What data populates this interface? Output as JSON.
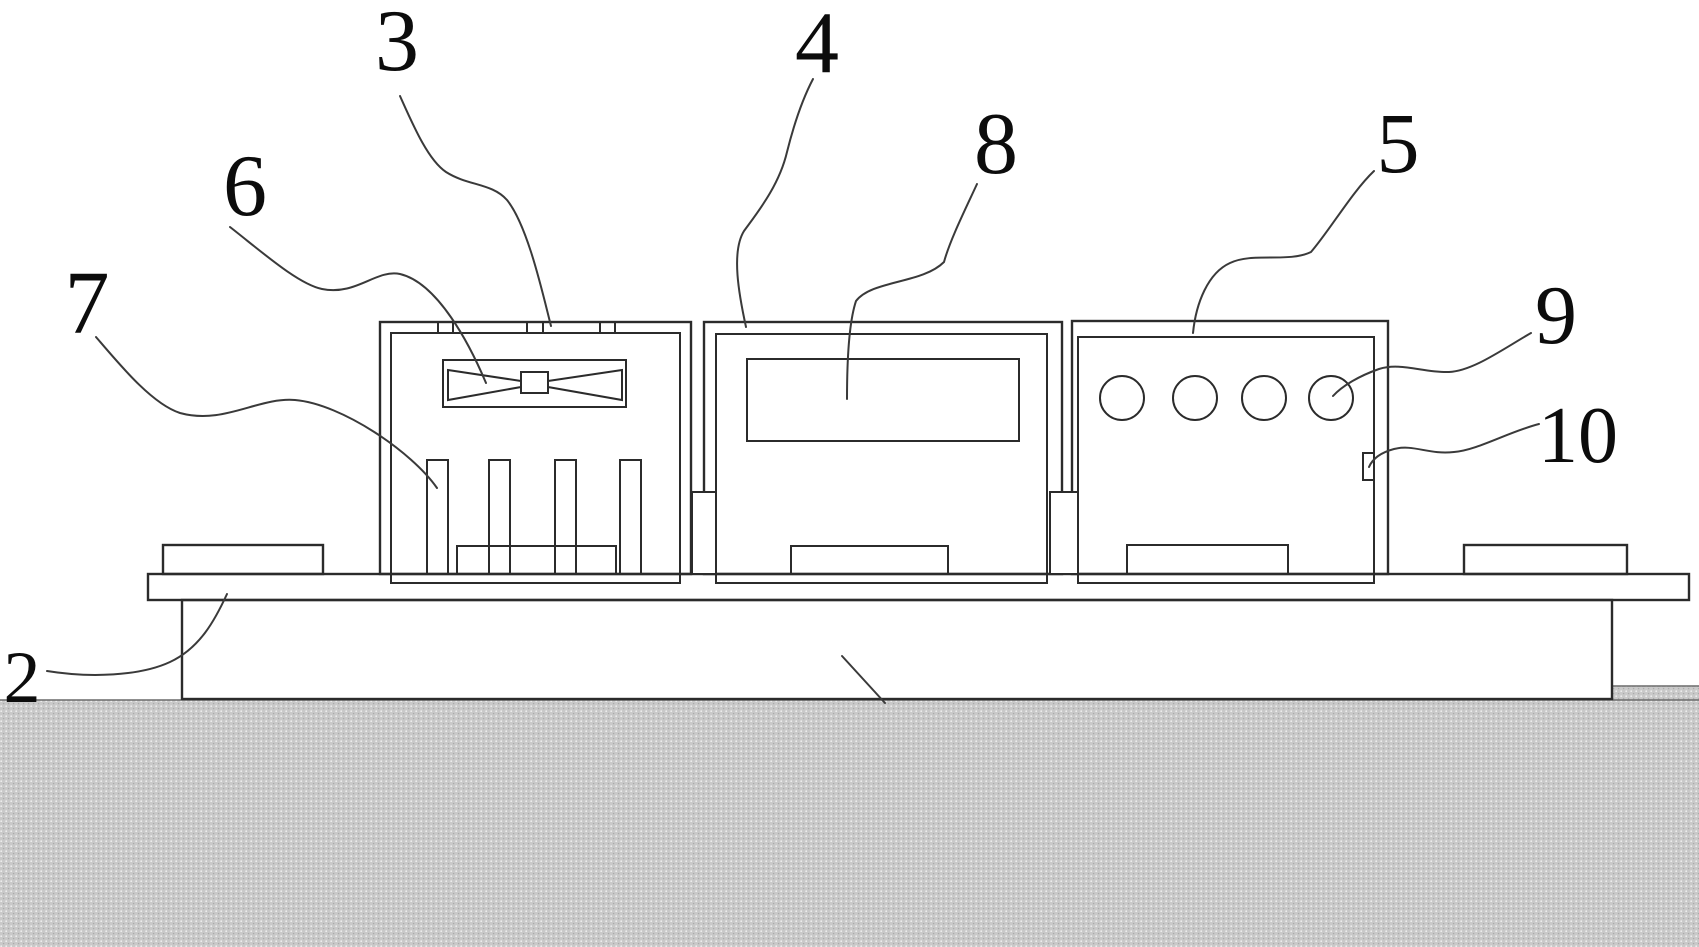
{
  "figure": {
    "kind": "patent-line-drawing",
    "background_color": "#ffffff",
    "line_color": "#2b2b2b",
    "ground_fill_color": "#c9c9c9",
    "parts": {
      "ground": "stippled-ground",
      "base": "machine-base-block",
      "platform": "support-plate",
      "module_left": "fan-and-pin-module",
      "module_middle": "display-module",
      "module_right": "button-hole-module"
    }
  },
  "labels": {
    "l2": {
      "text": "2"
    },
    "l3": {
      "text": "3"
    },
    "l4": {
      "text": "4"
    },
    "l5": {
      "text": "5"
    },
    "l6": {
      "text": "6"
    },
    "l7": {
      "text": "7"
    },
    "l8": {
      "text": "8"
    },
    "l9": {
      "text": "9"
    },
    "l10": {
      "text": "10"
    }
  }
}
